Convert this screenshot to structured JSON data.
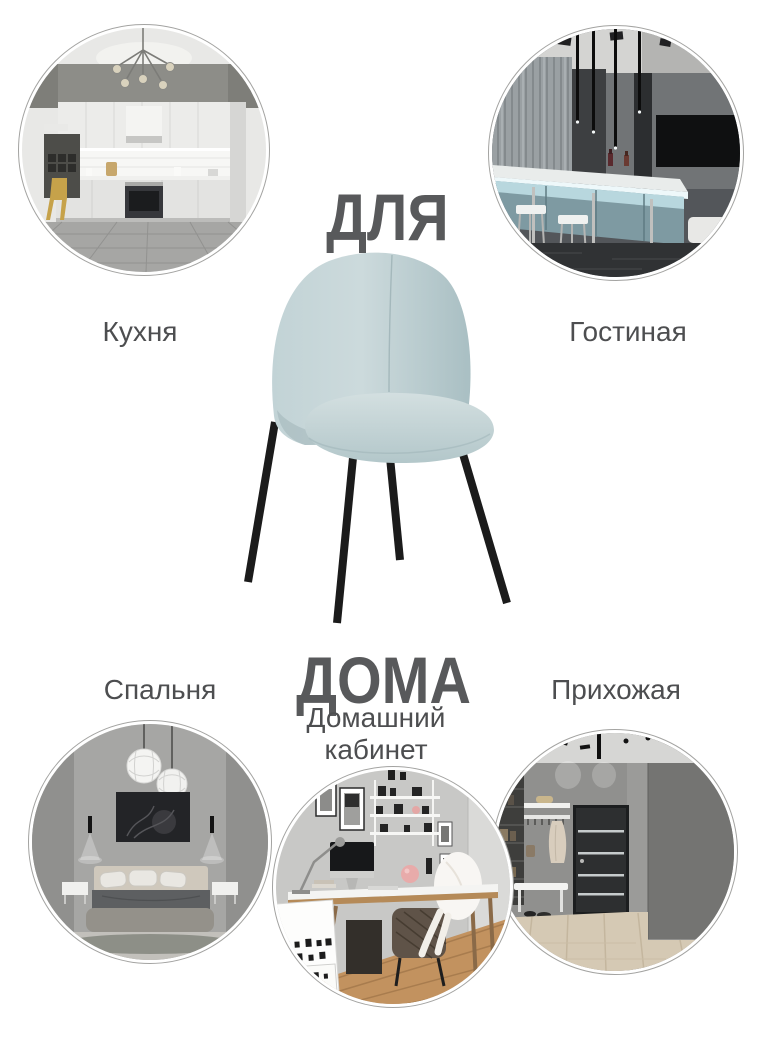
{
  "headline": {
    "line1": "ДЛЯ",
    "line2": "ДОМА"
  },
  "rooms": [
    {
      "id": "kitchen",
      "label": "Кухня",
      "position": "top-left"
    },
    {
      "id": "living-room",
      "label": "Гостиная",
      "position": "top-right"
    },
    {
      "id": "bedroom",
      "label": "Спальня",
      "position": "bottom-left"
    },
    {
      "id": "home-office",
      "label": "Домашний кабинет",
      "position": "bottom-center"
    },
    {
      "id": "hallway",
      "label": "Прихожая",
      "position": "bottom-right"
    }
  ],
  "product": {
    "type": "upholstered chair",
    "fabric_color": "#bfd1d3",
    "leg_color": "#1b1b1b"
  },
  "colors": {
    "background": "#ffffff",
    "headline_text": "#58595b",
    "label_text": "#4d4e50",
    "circle_ring": "#a3a3a1"
  }
}
